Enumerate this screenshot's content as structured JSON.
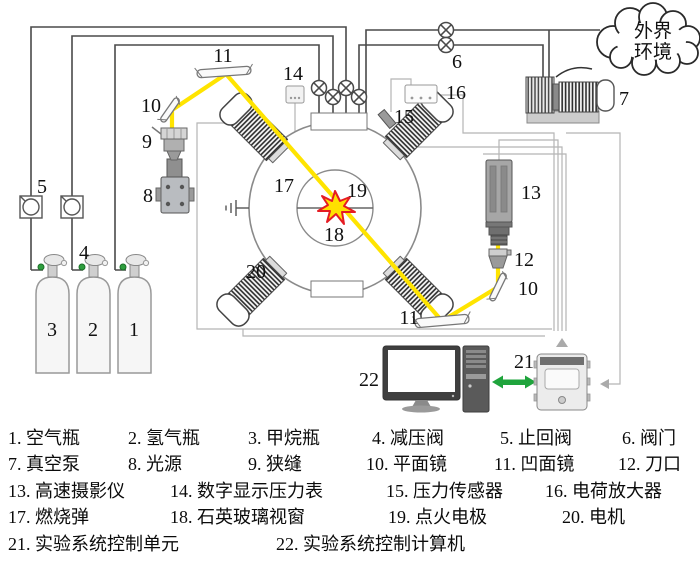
{
  "cloud": {
    "line1": "外界",
    "line2": "环境"
  },
  "labels": {
    "n1": "1",
    "n2": "2",
    "n3": "3",
    "n4": "4",
    "n5": "5",
    "n6": "6",
    "n7": "7",
    "n8": "8",
    "n9": "9",
    "n10a": "10",
    "n10b": "10",
    "n11a": "11",
    "n11b": "11",
    "n12": "12",
    "n13": "13",
    "n14": "14",
    "n15": "15",
    "n16": "16",
    "n17": "17",
    "n18": "18",
    "n19": "19",
    "n20": "20",
    "n21": "21",
    "n22": "22"
  },
  "legend": {
    "items": [
      "1. 空气瓶",
      "2. 氢气瓶",
      "3. 甲烷瓶",
      "4. 减压阀",
      "5. 止回阀",
      "6. 阀门",
      "7. 真空泵",
      "8. 光源",
      "9. 狭缝",
      "10. 平面镜",
      "11. 凹面镜",
      "12. 刀口",
      "13. 高速摄影仪",
      "14. 数字显示压力表",
      "15. 压力传感器",
      "16. 电荷放大器",
      "17. 燃烧弹",
      "18. 石英玻璃视窗",
      "19. 点火电极",
      "20. 电机",
      "21. 实验系统控制单元",
      "22. 实验系统控制计算机"
    ]
  },
  "colors": {
    "beam": "#FFE400",
    "star_fill": "#FFE000",
    "star_stroke": "#E51C23",
    "green_arrow": "#1FA43C",
    "pipe": "#4A4A4A",
    "signal_wire": "#B5B5B5"
  }
}
